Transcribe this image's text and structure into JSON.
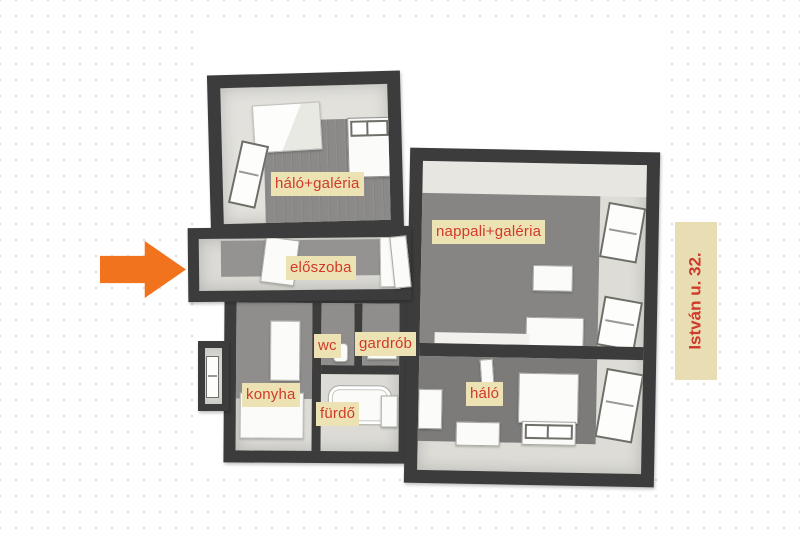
{
  "page": {
    "type": "apartment-floor-plan-3d"
  },
  "colors": {
    "dot": "#e3e1df",
    "wall_dark": "#3d3c3c",
    "wall_light": "#e2e1dc",
    "floor": "#8b8a88",
    "furniture": "#fbfbf9",
    "label_bg": "#ece2b3",
    "label_text": "#d13a28",
    "arrow": "#f2731e",
    "address_bg": "#e9ddb4",
    "address_text": "#cf3a2a"
  },
  "rooms": [
    {
      "id": "halo-galeria",
      "label": "háló+galéria"
    },
    {
      "id": "nappali-galeria",
      "label": "nappali+galéria"
    },
    {
      "id": "eloszoba",
      "label": "előszoba"
    },
    {
      "id": "wc",
      "label": "wc"
    },
    {
      "id": "gardrob",
      "label": "gardrób"
    },
    {
      "id": "konyha",
      "label": "konyha"
    },
    {
      "id": "furdo",
      "label": "fürdő"
    },
    {
      "id": "halo",
      "label": "háló"
    }
  ],
  "address": {
    "text": "István u. 32."
  },
  "icons": {
    "entrance_arrow": "right-arrow"
  }
}
